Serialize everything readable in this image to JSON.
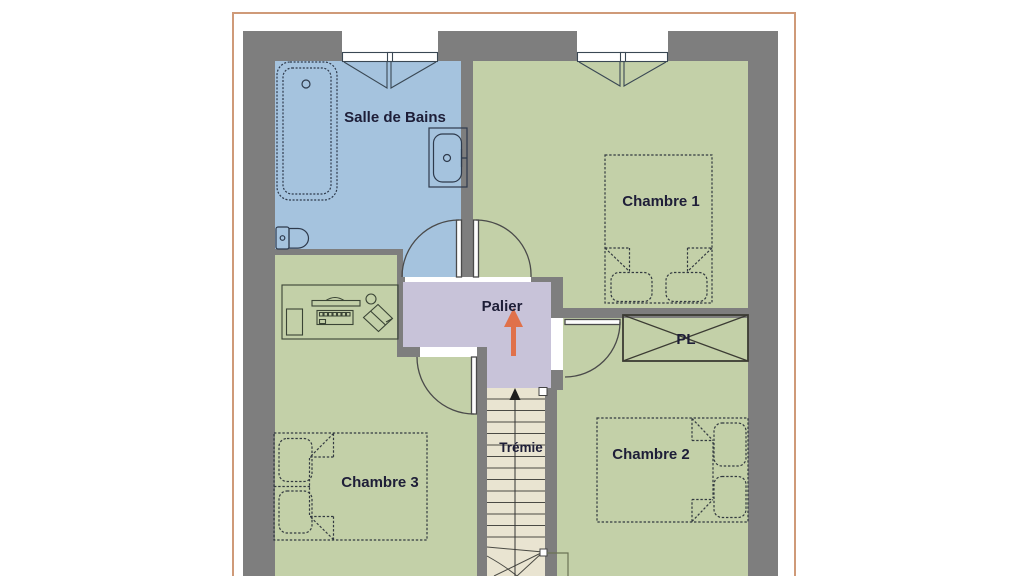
{
  "plan": {
    "rooms": {
      "salle_de_bains": {
        "label": "Salle de Bains",
        "color": "#a5c3de"
      },
      "chambre_1": {
        "label": "Chambre 1",
        "color": "#c3d0a8"
      },
      "chambre_2": {
        "label": "Chambre 2",
        "color": "#c3d0a8"
      },
      "chambre_3": {
        "label": "Chambre 3",
        "color": "#c3d0a8"
      },
      "palier": {
        "label": "Palier",
        "color": "#c8c3d9"
      },
      "tremie": {
        "label": "Trémie",
        "color": "#e9e4d1"
      },
      "placard": {
        "label": "PL",
        "color": "#c3d0a8"
      }
    },
    "colors": {
      "background": "#ffffff",
      "wall": "#7e7e7e",
      "border": "#cf9a78",
      "arrow": "#e0714a",
      "label_text": "#1e1e38",
      "furniture_line": "#2e3a4c",
      "door_line": "#4a4a4a",
      "stair_line": "#4a4a44",
      "railing_line": "#6b7355"
    },
    "furniture_symbols": [
      "bathtub",
      "toilet",
      "washbasin",
      "desk-with-computer",
      "double-bed-chambre-1",
      "double-bed-chambre-2",
      "double-bed-chambre-3",
      "closet-cross",
      "staircase-with-up-arrow",
      "window-casement"
    ]
  }
}
